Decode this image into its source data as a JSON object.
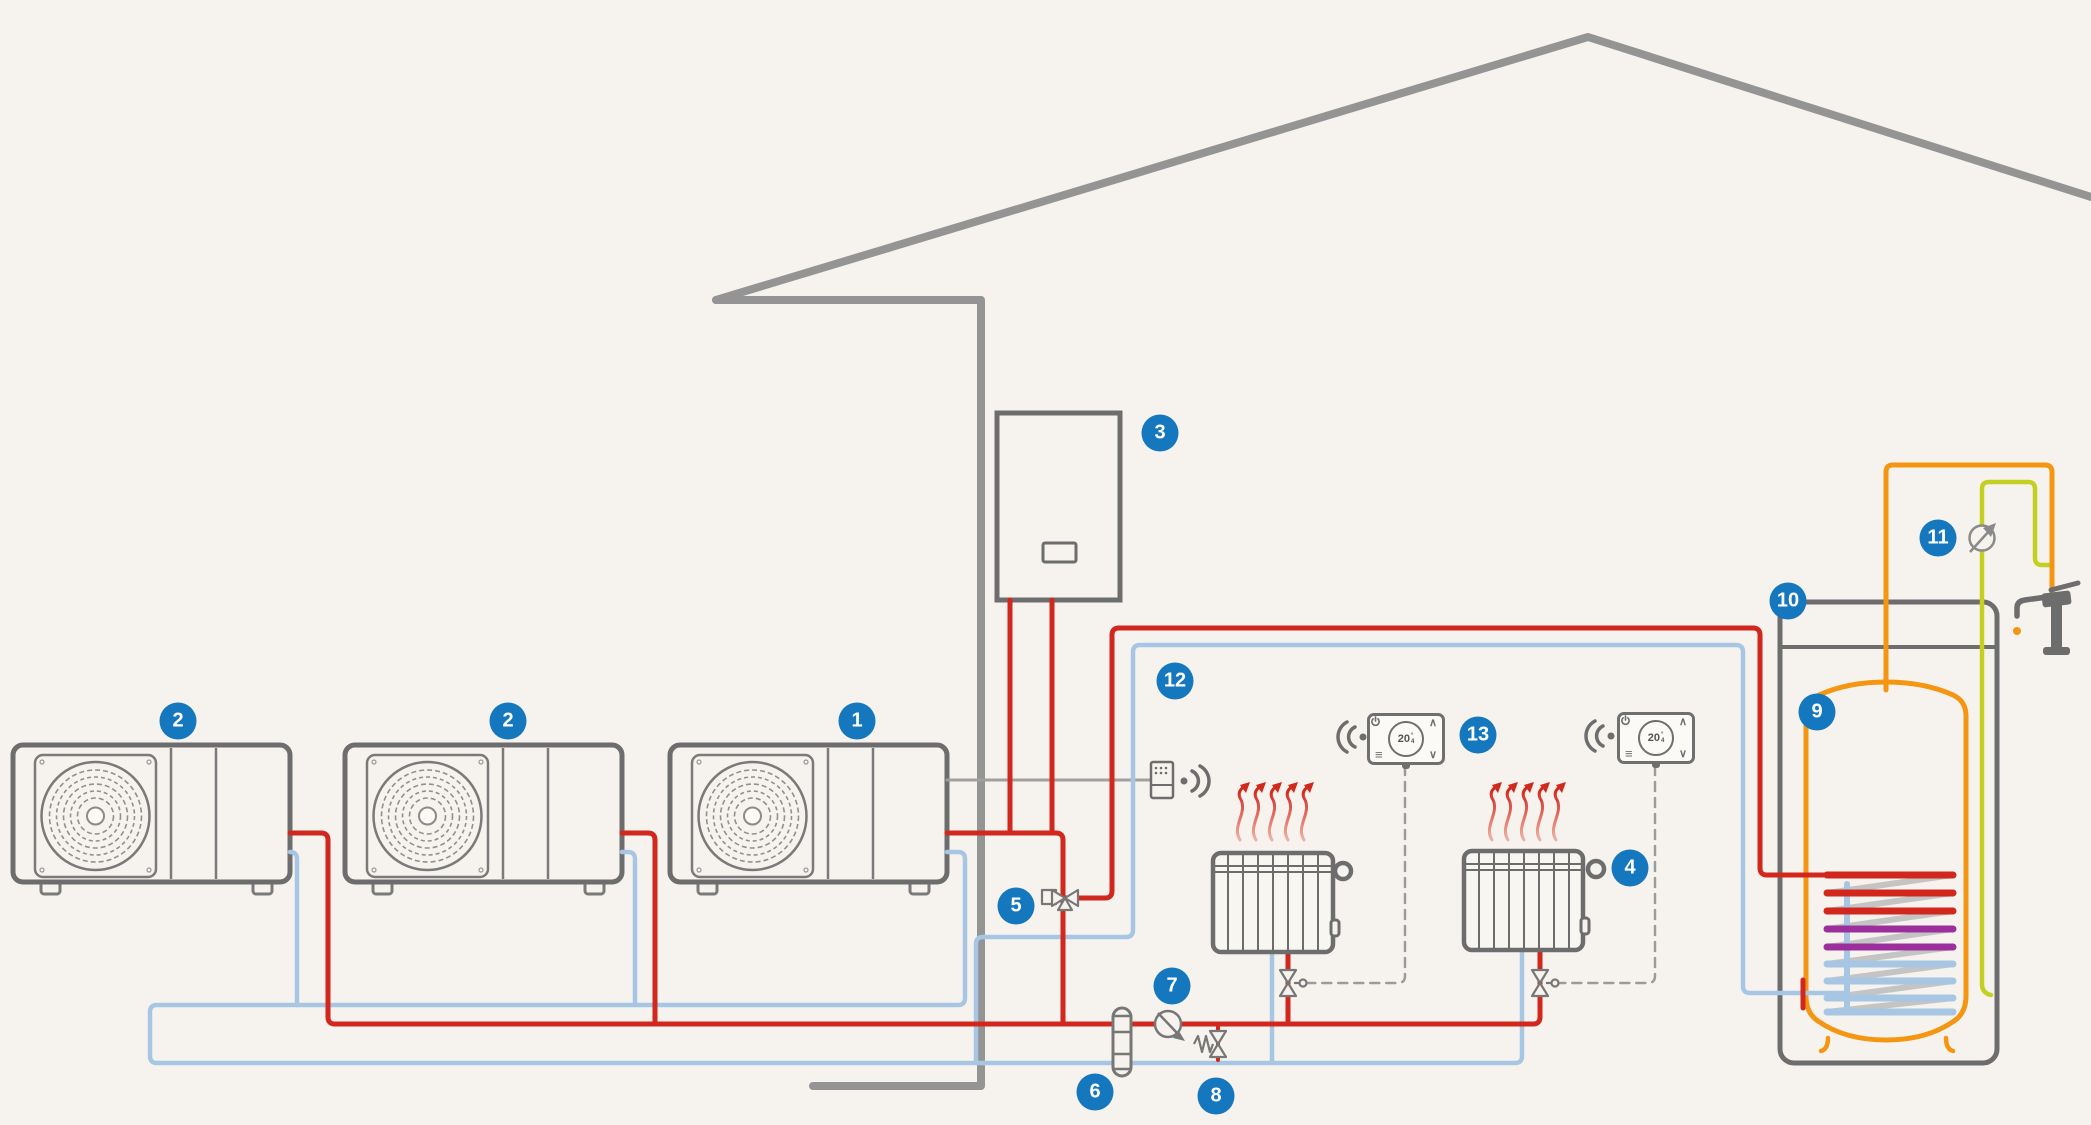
{
  "badges": [
    "1",
    "2",
    "2",
    "3",
    "4",
    "5",
    "6",
    "7",
    "8",
    "9",
    "10",
    "11",
    "12",
    "13"
  ],
  "thermostat": {
    "value": "20",
    "unit": "°",
    "decimal": "4"
  },
  "icons": {
    "menu": "≡",
    "chevron_up": "∧",
    "chevron_down": "∨",
    "power": "power-icon",
    "wifi_receive": "wifi-arcs-left",
    "wifi_transmit": "wifi-arcs-right"
  },
  "colors": {
    "background": "#f6f3ee",
    "badge_blue": "#1577bd",
    "pipe_hot_red": "#d2271d",
    "pipe_cold_blue": "#a6c6e3",
    "pipe_dhw_orange": "#f49612",
    "pipe_mains_yellow": "#c3d021",
    "coil_purple": "#9b2f9b",
    "outline_grey": "#6d6d6d",
    "house_grey": "#949494"
  }
}
